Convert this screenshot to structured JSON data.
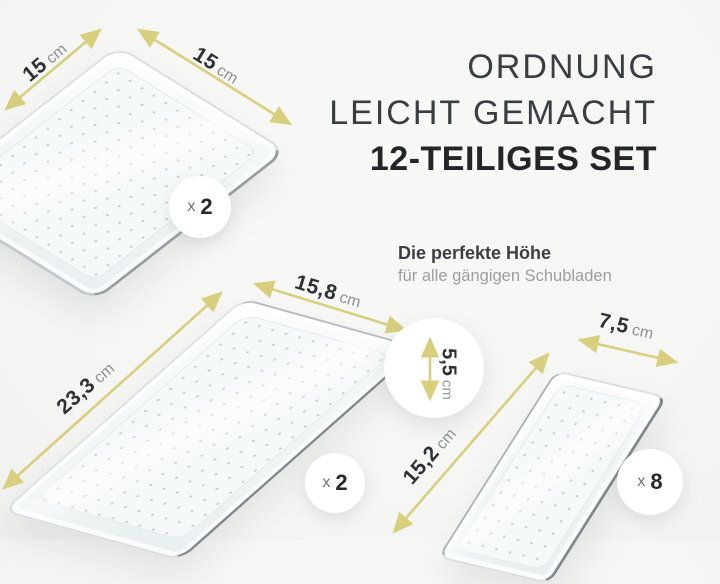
{
  "colors": {
    "accent": "#d8cf7e",
    "background": "#f5f5f3"
  },
  "heading": {
    "line1": "ORDNUNG",
    "line2": "LEICHT GEMACHT",
    "line3": "12-TEILIGES SET"
  },
  "subheading": {
    "title": "Die perfekte Höhe",
    "subtitle": "für alle gängigen Schubladen"
  },
  "dimensions": {
    "tray1_side_left": {
      "value": "15",
      "unit": "cm"
    },
    "tray1_side_right": {
      "value": "15",
      "unit": "cm"
    },
    "tray2_width": {
      "value": "15,8",
      "unit": "cm"
    },
    "tray2_length": {
      "value": "23,3",
      "unit": "cm"
    },
    "tray_height": {
      "value": "5,5",
      "unit": "cm"
    },
    "tray3_width": {
      "value": "7,5",
      "unit": "cm"
    },
    "tray3_length": {
      "value": "15,2",
      "unit": "cm"
    }
  },
  "badges": {
    "tray1": {
      "multiplier": "x",
      "count": "2"
    },
    "tray2": {
      "multiplier": "x",
      "count": "2"
    },
    "tray3": {
      "multiplier": "x",
      "count": "8"
    }
  }
}
